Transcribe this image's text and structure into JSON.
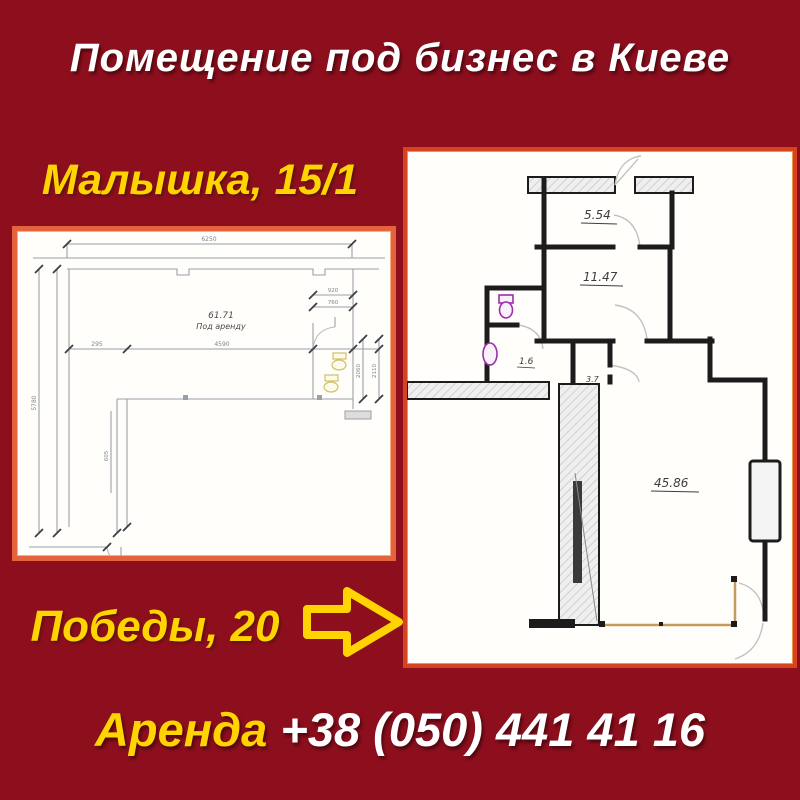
{
  "colors": {
    "background": "#8D0F1E",
    "accent_yellow": "#FFD400",
    "title_white": "#FFFFFF",
    "panel_border_left": "#E4633C",
    "panel_border_right": "#D8431F",
    "wall_black": "#1C1C1C",
    "cad_gray": "#9AA0A8",
    "fixture_purple": "#9B30A8",
    "demolition_tan": "#C49A5E"
  },
  "header": {
    "title": "Помещение под бизнес в Киеве"
  },
  "left_panel": {
    "address": "Малышка, 15/1",
    "plan": {
      "area_label": "61.71",
      "area_sub": "Под аренду",
      "dims": {
        "top": "6250",
        "left": "5780",
        "mid_left": "295",
        "mid": "4590",
        "bath_w": "920",
        "bath_w2": "760",
        "bath_h": "2060",
        "bath_h2": "2110",
        "inner": "605"
      }
    }
  },
  "right_panel": {
    "address": "Победы, 20",
    "plan": {
      "rooms": [
        {
          "label": "5.54"
        },
        {
          "label": "11.47"
        },
        {
          "label": "1.6"
        },
        {
          "label": "3.7"
        },
        {
          "label": "45.86"
        }
      ]
    }
  },
  "footer": {
    "rent_label": "Аренда",
    "phone": "+38 (050) 441 41 16"
  }
}
